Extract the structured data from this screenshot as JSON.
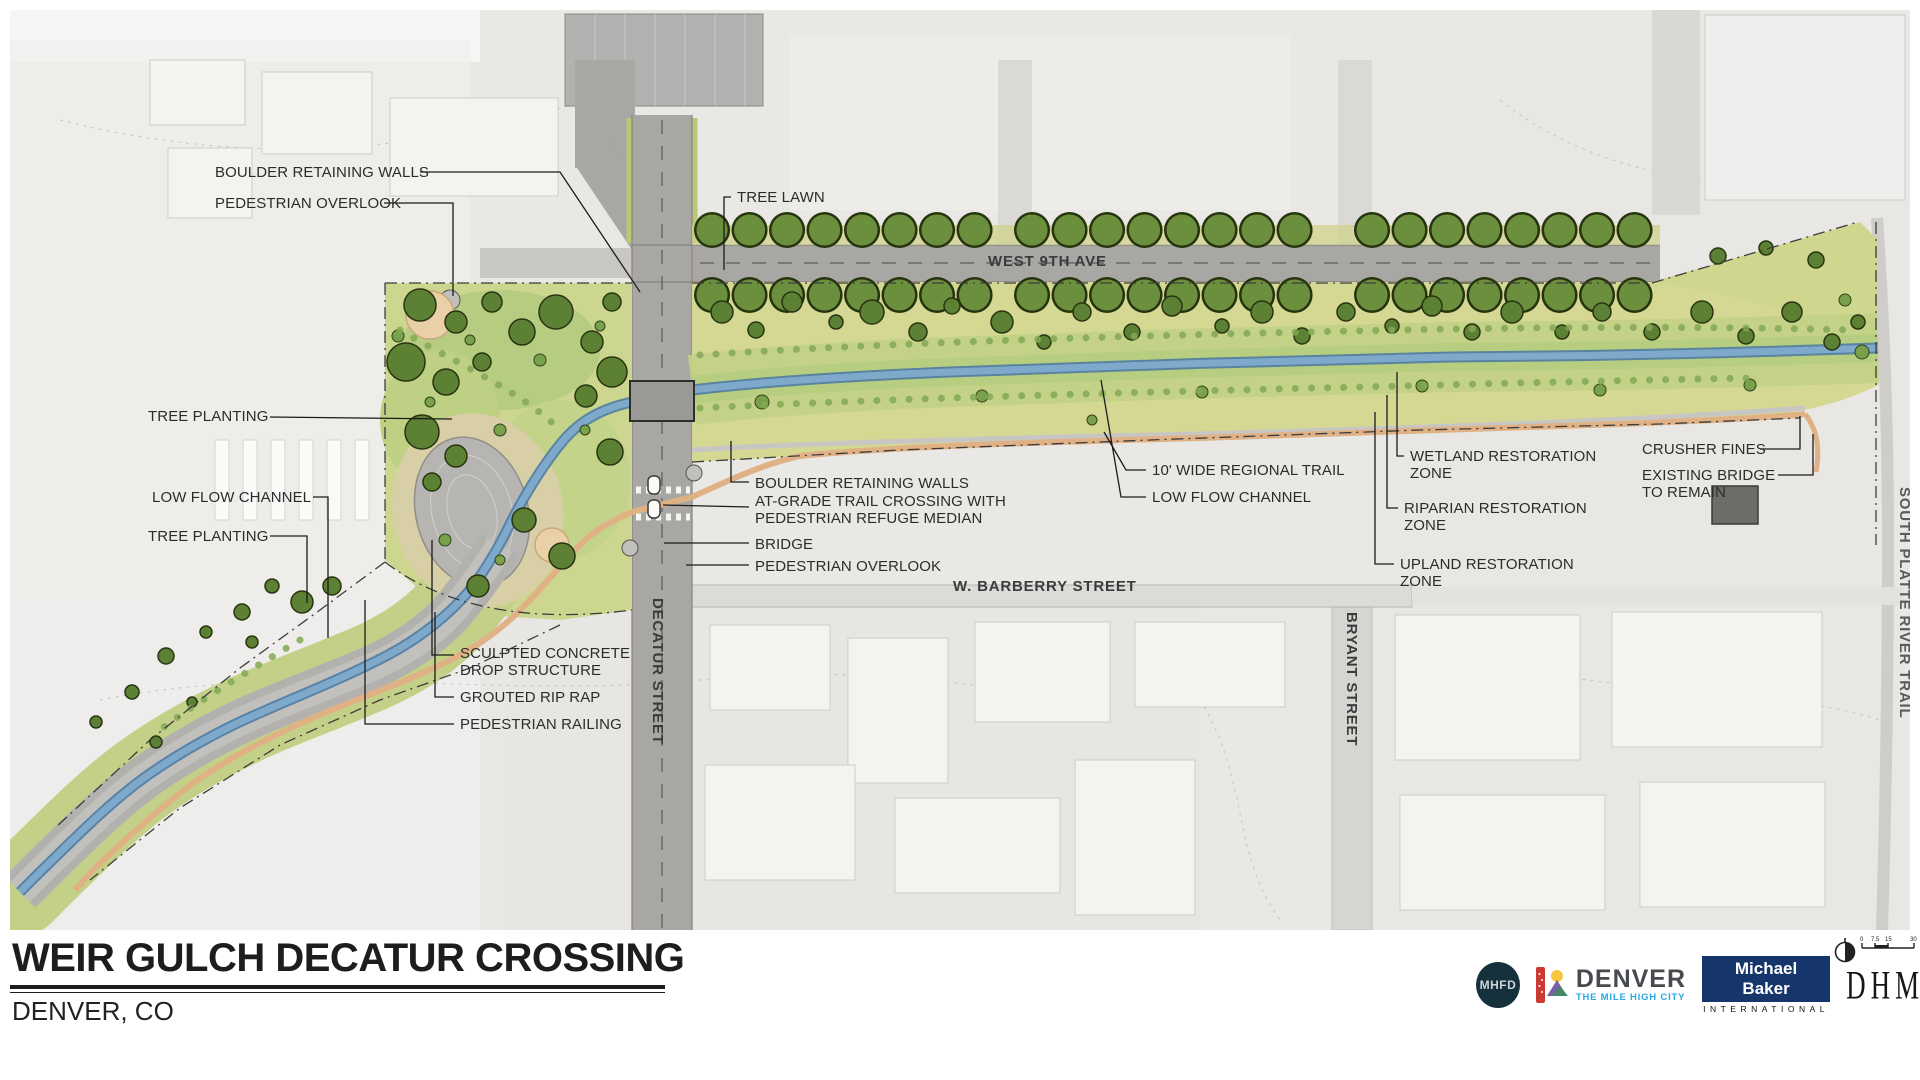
{
  "map": {
    "streets": {
      "west_9th": "WEST 9TH AVE",
      "barberry": "W. BARBERRY STREET",
      "decatur": "DECATUR STREET",
      "bryant": "BRYANT STREET",
      "south_platte_trail": "SOUTH PLATTE RIVER TRAIL"
    },
    "annotations": {
      "boulder_walls_top": "BOULDER RETAINING WALLS",
      "ped_overlook_top": "PEDESTRIAN OVERLOOK",
      "tree_lawn": "TREE LAWN",
      "tree_planting_upper": "TREE PLANTING",
      "low_flow_channel_left": "LOW FLOW CHANNEL",
      "tree_planting_lower": "TREE PLANTING",
      "boulder_walls_mid": "BOULDER RETAINING WALLS",
      "at_grade_crossing": "AT-GRADE TRAIL CROSSING WITH\nPEDESTRIAN REFUGE MEDIAN",
      "bridge": "BRIDGE",
      "ped_overlook_mid": "PEDESTRIAN OVERLOOK",
      "regional_trail": "10' WIDE REGIONAL TRAIL",
      "low_flow_channel_right": "LOW FLOW CHANNEL",
      "wetland_zone": "WETLAND RESTORATION\nZONE",
      "riparian_zone": "RIPARIAN RESTORATION\nZONE",
      "upland_zone": "UPLAND RESTORATION\nZONE",
      "crusher_fines": "CRUSHER FINES",
      "existing_bridge": "EXISTING BRIDGE\nTO REMAIN",
      "sculpted_drop": "SCULPTED CONCRETE\nDROP STRUCTURE",
      "grouted_rip_rap": "GROUTED RIP RAP",
      "ped_railing": "PEDESTRIAN RAILING"
    }
  },
  "title_block": {
    "title": "WEIR GULCH DECATUR CROSSING",
    "subtitle": "DENVER, CO",
    "scale": {
      "t0": "0",
      "t1": "7.5",
      "t2": "15",
      "t3": "30"
    },
    "logos": {
      "mhfd": "MHFD",
      "denver": "DENVER",
      "denver_tagline": "THE MILE HIGH CITY",
      "michael_baker": "Michael Baker",
      "michael_baker_sub": "INTERNATIONAL",
      "dhm": "DHM DESIGN"
    }
  },
  "colors": {
    "park_green": "#ccd68e",
    "lawn_green": "#b6cc80",
    "tree_green": "#5d8134",
    "stream_blue": "#7fa9cb",
    "trail_tan": "#dfb184",
    "road_grey": "#a9a7a4",
    "pond_grey": "#b7b5b2",
    "plaza_tan": "#ead0a6"
  }
}
